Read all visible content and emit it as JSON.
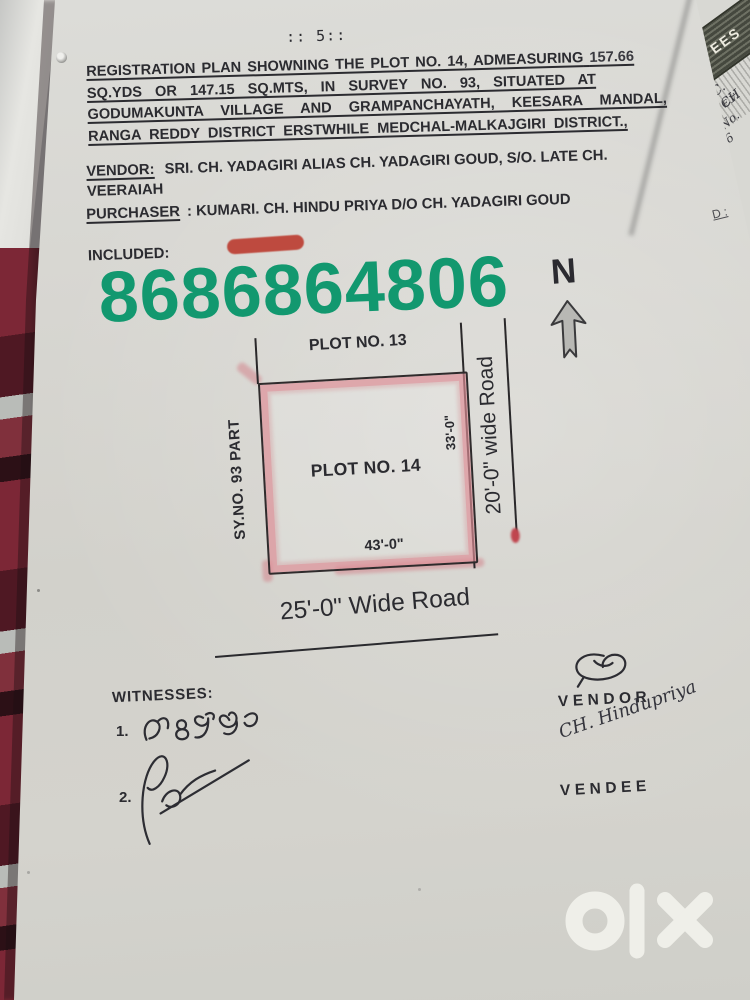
{
  "document": {
    "page_number": ":: 5::",
    "title_lines": [
      "REGISTRATION PLAN SHOWNING THE PLOT NO. 14, ADMEASURING",
      "SQ.YDS OR 147.15 SQ.MTS, IN SURVEY NO. 93, SITUATED AT",
      "GODUMAKUNTA VILLAGE AND GRAMPANCHAYATH, KEESARA MANDAL,",
      "RANGA REDDY DISTRICT ERSTWHILE MEDCHAL-MALKAJGIRI DISTRICT.,"
    ],
    "title_line1_number": "157.66",
    "vendor_label": "VENDOR:",
    "vendor_line1": "SRI. CH. YADAGIRI ALIAS CH. YADAGIRI GOUD, S/O. LATE CH.",
    "vendor_line2": "VEERAIAH",
    "purchaser_label": "PURCHASER",
    "purchaser_text": ": KUMARI. CH. HINDU PRIYA D/O CH. YADAGIRI GOUD",
    "included_label": "INCLUDED:",
    "phone_number": "8686864806",
    "compass_north": "N",
    "plan": {
      "plot_above": "PLOT NO. 13",
      "plot_main": "PLOT NO. 14",
      "survey_label": "SY.NO. 93 PART",
      "right_dim": "33'-0\"",
      "bottom_dim": "43'-0\"",
      "right_road": "20'-0\" wide Road",
      "bottom_road": "25'-0\" Wide Road"
    },
    "witnesses_label": "WITNESSES:",
    "witness_1_number": "1.",
    "witness_2_number": "2.",
    "vendor_sign_label": "VENDOR",
    "vendee_sign_label": "VENDEE",
    "vendee_signature_text": "CH. Hindupriya",
    "docket_note": "D :"
  },
  "background_document": {
    "stamp_fragment": "EES",
    "hand_note_1": "C. CH",
    "hand_note_2": "E.V.",
    "hand_note_3": "L.No. 16"
  },
  "colors": {
    "phone_green": "#12986f",
    "marker_pink": "#dd8a94",
    "redaction_red": "#bd4337",
    "paper": "#d4d3cd"
  }
}
